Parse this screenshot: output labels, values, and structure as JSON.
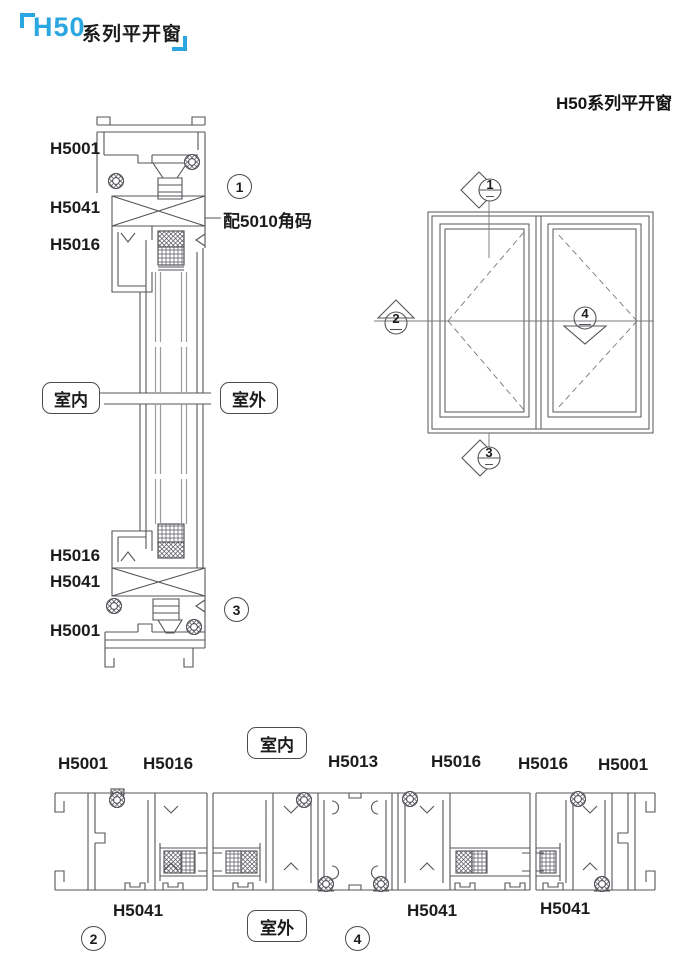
{
  "title": {
    "brand": "H50",
    "series": "系列平开窗"
  },
  "heading_right": "H50系列平开窗",
  "vertical_section": {
    "profile_labels": [
      "H5001",
      "H5041",
      "H5016",
      "H5016",
      "H5041",
      "H5001"
    ],
    "corner_note": "配5010角码",
    "indoor_label": "室内",
    "outdoor_label": "室外",
    "detail_marker_top": "1",
    "detail_marker_bottom": "3"
  },
  "elevation": {
    "section_markers": {
      "top": "1",
      "left": "2",
      "bottom": "3",
      "right_mid": "4"
    }
  },
  "horizontal_section": {
    "top_labels": [
      "H5001",
      "H5016",
      "H5013",
      "H5016",
      "H5016",
      "H5001"
    ],
    "bottom_labels": [
      "H5041",
      "H5041",
      "H5041"
    ],
    "indoor_label": "室内",
    "outdoor_label": "室外",
    "detail_marker_left": "2",
    "detail_marker_right": "4"
  },
  "colors": {
    "accent_blue": "#2aa7e0",
    "ink": "#1c1c1c",
    "line": "#54555a"
  }
}
